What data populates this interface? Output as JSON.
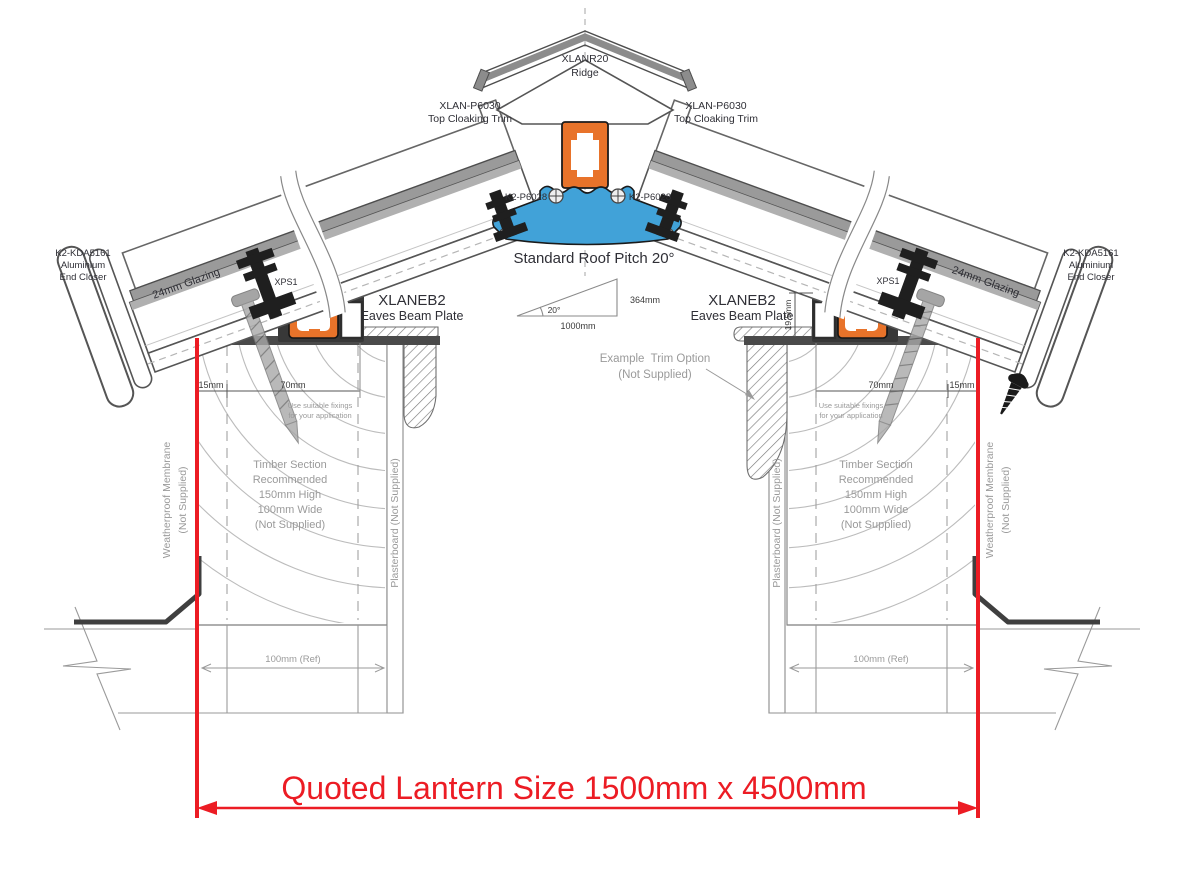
{
  "colors": {
    "accent_orange": "#E8732A",
    "accent_blue": "#41A2D8",
    "dimension_red": "#EC1C24",
    "label_dark": "#2F2F36",
    "label_gray": "#9A9A9A"
  },
  "labels": {
    "ridge": {
      "part": "XLANR20",
      "name": "Ridge"
    },
    "cloaking_left": {
      "part": "XLAN-P6030",
      "name": "Top Cloaking Trim"
    },
    "cloaking_right": {
      "part": "XLAN-P6030",
      "name": "Top Cloaking Trim"
    },
    "ridge_fixing_left": "K2-P6028",
    "ridge_fixing_right": "K2-P6028",
    "pitch_title": "Standard Roof Pitch 20°",
    "pitch": {
      "angle": "20°",
      "run": "1000mm",
      "rise": "364mm"
    },
    "eaves_left": {
      "part": "XLANEB2",
      "name": "Eaves Beam Plate"
    },
    "eaves_right": {
      "part": "XLANEB2",
      "name": "Eaves Beam Plate"
    },
    "xps_left": "XPS1",
    "xps_right": "XPS1",
    "end_closer_left": {
      "part": "K2-KDA5161",
      "line1": "Aluminium",
      "line2": "End Closer"
    },
    "end_closer_right": {
      "part": "K2-KDA5161",
      "line1": "Aluminium",
      "line2": "End Closer"
    },
    "glazing_left": "24mm Glazing",
    "glazing_right": "24mm Glazing",
    "dims": {
      "left_15": "15mm",
      "left_70": "70mm",
      "right_70": "70mm",
      "right_15": "15mm",
      "beam_height": "19.5mm",
      "ref_left": "100mm (Ref)",
      "ref_right": "100mm (Ref)"
    },
    "fixing_note_left": {
      "line1": "Use suitable fixings",
      "line2": "for your application"
    },
    "fixing_note_right": {
      "line1": "Use suitable fixings",
      "line2": "for your application"
    },
    "trim_option": {
      "line1": "Example  Trim Option",
      "line2": "(Not Supplied)"
    },
    "timber_left": {
      "line1": "Timber Section",
      "line2": "Recommended",
      "line3": "150mm High",
      "line4": "100mm Wide",
      "line5": "(Not Supplied)"
    },
    "timber_right": {
      "line1": "Timber Section",
      "line2": "Recommended",
      "line3": "150mm High",
      "line4": "100mm Wide",
      "line5": "(Not Supplied)"
    },
    "membrane_left": {
      "line1": "Weatherproof Membrane",
      "line2": "(Not Supplied)"
    },
    "membrane_right": {
      "line1": "Weatherproof Membrane",
      "line2": "(Not Supplied)"
    },
    "plasterboard_left": "Plasterboard (Not Supplied)",
    "plasterboard_right": "Plasterboard (Not Supplied)",
    "quoted_size": "Quoted Lantern Size 1500mm x 4500mm"
  }
}
